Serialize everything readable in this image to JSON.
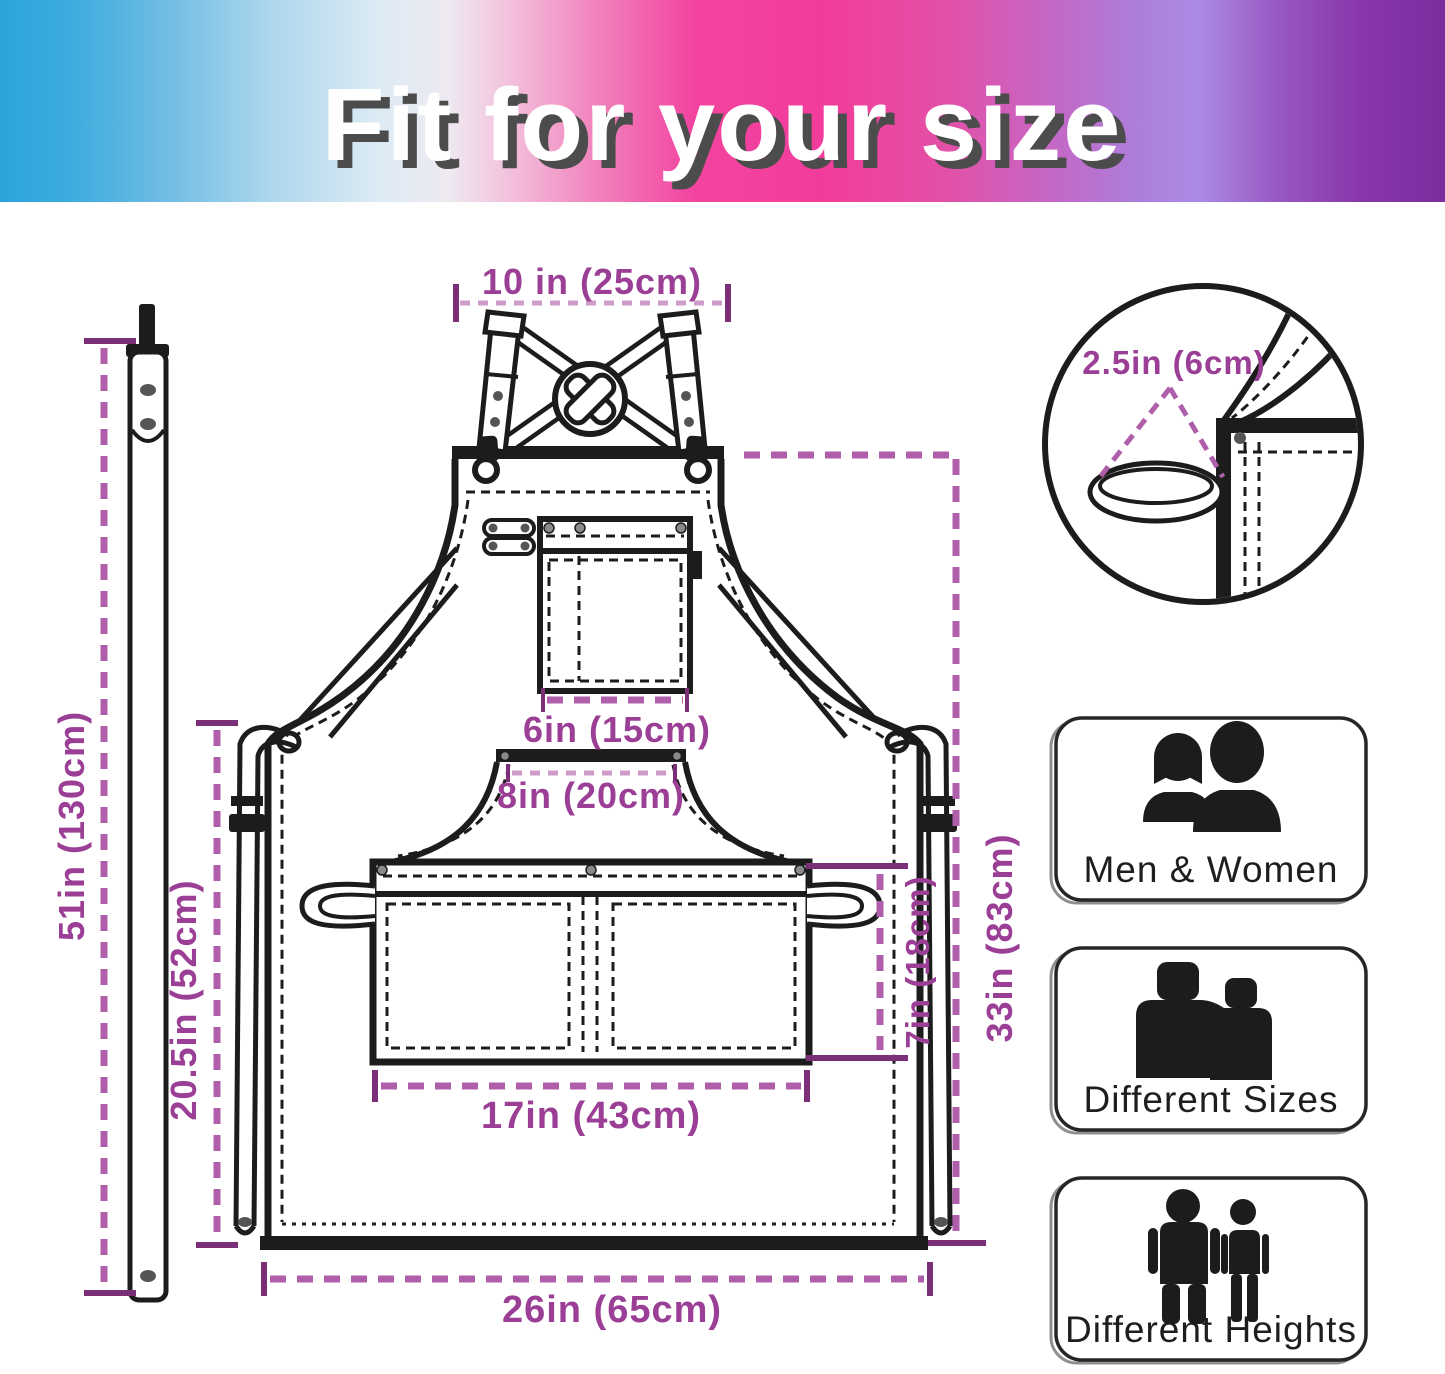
{
  "banner": {
    "title": "Fit for your size"
  },
  "measurements": {
    "neck_strap_width": "10 in (25cm)",
    "hanging_loop": "2.5in (6cm)",
    "adjustable_strap_length": "51in (130cm)",
    "side_tie_length": "20.5in (52cm)",
    "chest_pocket_width": "6in (15cm)",
    "waist_pocket_top_width": "8in (20cm)",
    "waist_pocket_width": "17in (43cm)",
    "waist_pocket_height": "7in (18cm)",
    "apron_length": "33in (83cm)",
    "apron_width": "26in (65cm)"
  },
  "features": [
    {
      "label": "Men & Women",
      "icon": "man-woman-busts-icon"
    },
    {
      "label": "Different Sizes",
      "icon": "different-sizes-icon"
    },
    {
      "label": "Different Heights",
      "icon": "different-heights-icon"
    }
  ],
  "colors": {
    "banner_gradient": [
      "#2CA4DB",
      "#3DACDE",
      "#74BEE4",
      "#AFD8EE",
      "#DCEBF4",
      "#EEE9F1",
      "#F3C3DE",
      "#F185BE",
      "#F2449F",
      "#F23C9C",
      "#E44FA6",
      "#C468C6",
      "#AC7FDC",
      "#AB8BE5",
      "#9A5BC4",
      "#8837AA",
      "#7B2D9E"
    ],
    "dimension_text": "#9B3E96",
    "dimension_line": "#AF5FAA",
    "dimension_line_light": "#CE9BCA",
    "dimension_tick": "#7C2F79",
    "line_ink": "#1C1C1C"
  }
}
